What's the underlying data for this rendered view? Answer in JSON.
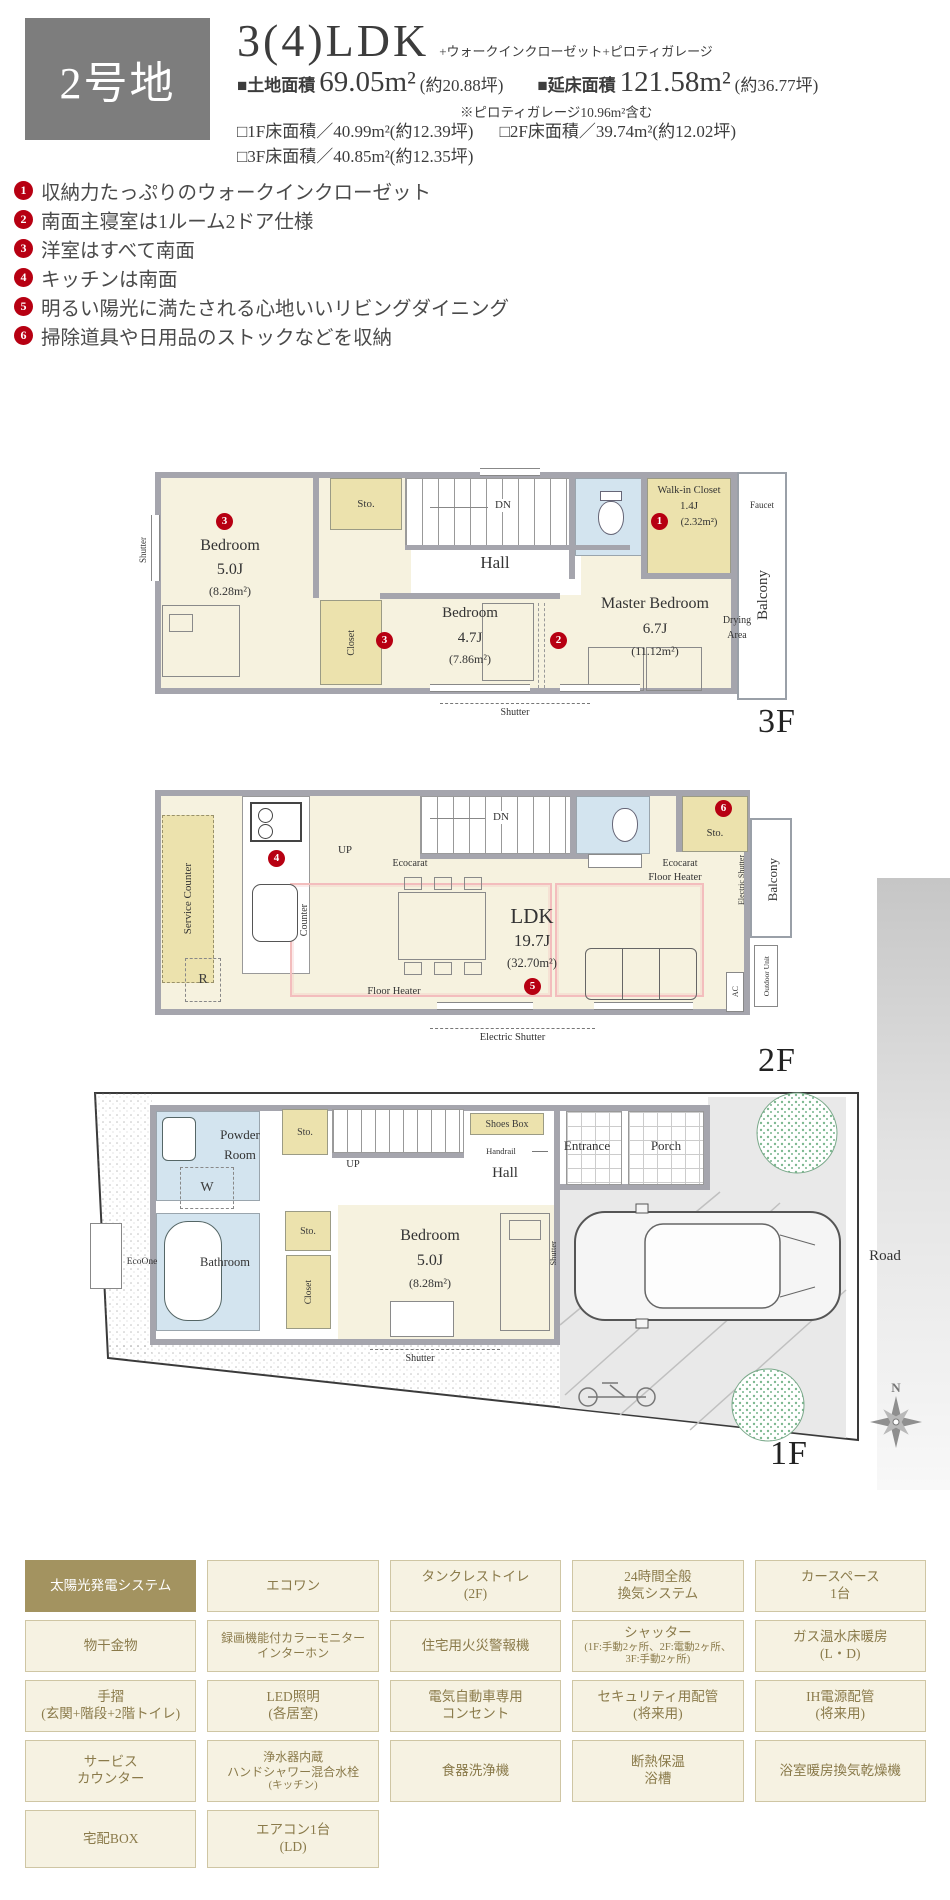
{
  "header": {
    "lot": "2号地",
    "plan_type": "3(4)LDK",
    "plan_suffix": "+ウォークインクローゼット+ピロティガレージ",
    "land_label": "■土地面積",
    "land_value": "69.05m²",
    "land_tsubo": "(約20.88坪)",
    "total_label": "■延床面積",
    "total_value": "121.58m²",
    "total_tsubo": "(約36.77坪)",
    "total_note": "※ピロティガレージ10.96m²含む",
    "f1": "□1F床面積／40.99m²(約12.39坪)",
    "f2": "□2F床面積／39.74m²(約12.02坪)",
    "f3": "□3F床面積／40.85m²(約12.35坪)"
  },
  "features": [
    {
      "num": "1",
      "text": "収納力たっぷりのウォークインクローゼット"
    },
    {
      "num": "2",
      "text": "南面主寝室は1ルーム2ドア仕様"
    },
    {
      "num": "3",
      "text": "洋室はすべて南面"
    },
    {
      "num": "4",
      "text": "キッチンは南面"
    },
    {
      "num": "5",
      "text": "明るい陽光に満たされる心地いいリビングダイニング"
    },
    {
      "num": "6",
      "text": "掃除道具や日用品のストックなどを収納"
    }
  ],
  "plan3f": {
    "floor": "3F",
    "bedroom5": {
      "badge": "3",
      "name": "Bedroom",
      "size": "5.0J",
      "area": "(8.28m²)"
    },
    "bedroom47": {
      "badge": "3",
      "name": "Bedroom",
      "size": "4.7J",
      "area": "(7.86m²)"
    },
    "master": {
      "badge": "2",
      "name": "Master Bedroom",
      "size": "6.7J",
      "area": "(11.12m²)"
    },
    "wic": {
      "badge": "1",
      "name": "Walk-in Closet",
      "size": "1.4J",
      "area": "(2.32m²)"
    },
    "hall": "Hall",
    "sto": "Sto.",
    "closet": "Closet",
    "dn": "DN",
    "balcony": "Balcony",
    "faucet": "Faucet",
    "drying": "Drying\nArea",
    "shutter_left": "Shutter",
    "shutter_bottom": "Shutter"
  },
  "plan2f": {
    "floor": "2F",
    "ldk": {
      "badge": "5",
      "name": "LDK",
      "size": "19.7J",
      "area": "(32.70m²)"
    },
    "badge_kitchen": "4",
    "badge_sto": "6",
    "service_counter": "Service Counter",
    "counter": "Counter",
    "up": "UP",
    "dn": "DN",
    "ecocarat": "Ecocarat",
    "ecocarat2": "Ecocarat",
    "sto": "Sto.",
    "floor_heater": "Floor Heater",
    "floor_heater2": "Floor Heater",
    "fridge": "R",
    "ac": "AC",
    "outdoor_unit": "Outdoor Unit",
    "electric_shutter_side": "Electric Shutter",
    "electric_shutter_bottom": "Electric Shutter",
    "balcony": "Balcony"
  },
  "plan1f": {
    "floor": "1F",
    "bedroom": {
      "name": "Bedroom",
      "size": "5.0J",
      "area": "(8.28m²)"
    },
    "powder_room": "Powder\nRoom",
    "washer": "W",
    "sto_upper": "Sto.",
    "sto_lower": "Sto.",
    "up": "UP",
    "shoes_box": "Shoes Box",
    "handrail": "Handrail",
    "hall": "Hall",
    "entrance": "Entrance",
    "porch": "Porch",
    "ecoone": "EcoOne",
    "bathroom": "Bathroom",
    "closet": "Closet",
    "shutter_side": "Shutter",
    "shutter_bottom": "Shutter",
    "road": "Road",
    "north": "N"
  },
  "amenities": [
    {
      "label": "太陽光発電システム",
      "highlight": true
    },
    {
      "label": "エコワン"
    },
    {
      "label": "タンクレストイレ\n(2F)"
    },
    {
      "label": "24時間全般\n換気システム"
    },
    {
      "label": "カースペース\n1台"
    },
    {
      "label": "物干金物"
    },
    {
      "label": "録画機能付カラーモニター\nインターホン"
    },
    {
      "label": "住宅用火災警報機"
    },
    {
      "label": "シャッター",
      "sub": "(1F:手動2ヶ所、2F:電動2ヶ所、\n3F:手動2ヶ所)"
    },
    {
      "label": "ガス温水床暖房\n(L・D)"
    },
    {
      "label": "手摺\n(玄関+階段+2階トイレ)"
    },
    {
      "label": "LED照明\n(各居室)"
    },
    {
      "label": "電気自動車専用\nコンセント"
    },
    {
      "label": "セキュリティ用配管\n(将来用)"
    },
    {
      "label": "IH電源配管\n(将来用)"
    },
    {
      "label": "サービス\nカウンター"
    },
    {
      "label": "浄水器内蔵\nハンドシャワー混合水栓",
      "sub": "(キッチン)"
    },
    {
      "label": "食器洗浄機"
    },
    {
      "label": "断熱保温\n浴槽"
    },
    {
      "label": "浴室暖房換気乾燥機"
    },
    {
      "label": "宅配BOX"
    },
    {
      "label": "エアコン1台\n(LD)"
    }
  ],
  "colors": {
    "badge": "#b70012",
    "highlight": "#a39360",
    "wall": "#a5a5ad",
    "room": "#f6f2df",
    "closet": "#ece2ad",
    "wet": "#d3e4ef",
    "heater": "#f3bdbd"
  }
}
